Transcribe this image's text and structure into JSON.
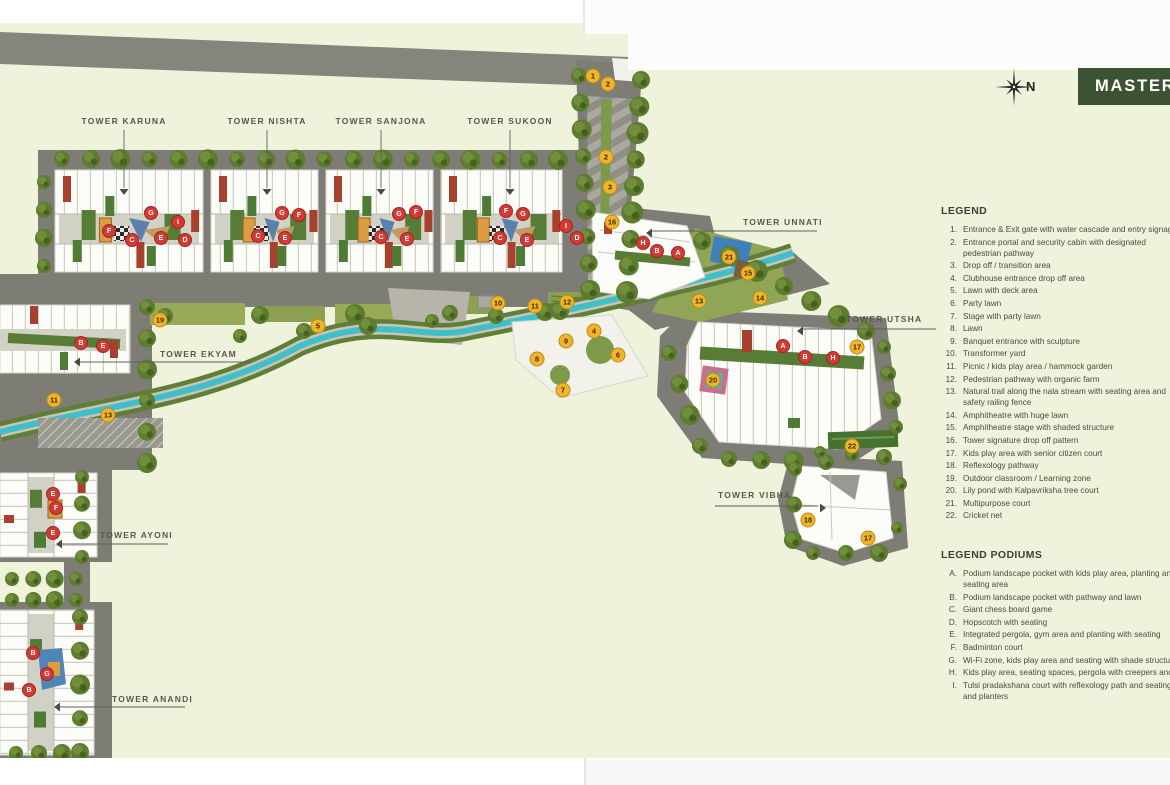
{
  "page": {
    "banner_label": "MASTER PLAN",
    "compass_label": "N"
  },
  "legend": {
    "title": "LEGEND",
    "items": [
      {
        "n": "1.",
        "t": "Entrance & Exit gate with water cascade and entry signage"
      },
      {
        "n": "2.",
        "t": "Entrance portal and security cabin with designated\npedestrian pathway"
      },
      {
        "n": "3.",
        "t": "Drop off / transition area"
      },
      {
        "n": "4.",
        "t": "Clubhouse entrance drop off area"
      },
      {
        "n": "5.",
        "t": "Lawn with deck area"
      },
      {
        "n": "6.",
        "t": "Party lawn"
      },
      {
        "n": "7.",
        "t": "Stage with party lawn"
      },
      {
        "n": "8.",
        "t": "Lawn"
      },
      {
        "n": "9.",
        "t": "Banquet entrance with sculpture"
      },
      {
        "n": "10.",
        "t": "Transformer yard"
      },
      {
        "n": "11.",
        "t": "Picnic / kids play area / hammock garden"
      },
      {
        "n": "12.",
        "t": "Pedestrian pathway with organic farm"
      },
      {
        "n": "13.",
        "t": "Natural trail along the nala stream with seating area and\nsafety railing fence"
      },
      {
        "n": "14.",
        "t": "Amphitheatre with huge lawn"
      },
      {
        "n": "15.",
        "t": "Amphitheatre stage with shaded structure"
      },
      {
        "n": "16.",
        "t": "Tower signature drop off pattern"
      },
      {
        "n": "17.",
        "t": "Kids play area with senior citizen court"
      },
      {
        "n": "18.",
        "t": "Reflexology pathway"
      },
      {
        "n": "19.",
        "t": "Outdoor classroom / Learning zone"
      },
      {
        "n": "20.",
        "t": "Lily pond with Kalpavriksha tree court"
      },
      {
        "n": "21.",
        "t": "Multipurpose court"
      },
      {
        "n": "22.",
        "t": "Cricket net"
      }
    ]
  },
  "legend_podiums": {
    "title": "LEGEND PODIUMS",
    "items": [
      {
        "n": "A.",
        "t": "Podium landscape pocket with kids play area, planting and\nseating area"
      },
      {
        "n": "B.",
        "t": "Podium landscape pocket with pathway and lawn"
      },
      {
        "n": "C.",
        "t": "Giant chess board game"
      },
      {
        "n": "D.",
        "t": "Hopscotch with seating"
      },
      {
        "n": "E.",
        "t": "Integrated pergola, gym area and planting with seating"
      },
      {
        "n": "F.",
        "t": "Badminton court"
      },
      {
        "n": "G.",
        "t": "Wi-Fi zone, kids play area and seating with shade structure"
      },
      {
        "n": "H.",
        "t": "Kids play area, seating spaces, pergola with creepers and"
      },
      {
        "n": "I.",
        "t": "Tulsi pradakshana court with reflexology path and seating\nand planters"
      }
    ]
  },
  "plan": {
    "towers": [
      {
        "id": "karuna",
        "name": "TOWER KARUNA"
      },
      {
        "id": "nishta",
        "name": "TOWER NISHTA"
      },
      {
        "id": "sanjona",
        "name": "TOWER SANJONA"
      },
      {
        "id": "sukoon",
        "name": "TOWER SUKOON"
      },
      {
        "id": "unnati",
        "name": "TOWER UNNATI"
      },
      {
        "id": "utsha",
        "name": "TOWER UTSHA"
      },
      {
        "id": "ekyam",
        "name": "TOWER EKYAM"
      },
      {
        "id": "ayoni",
        "name": "TOWER AYONI"
      },
      {
        "id": "vibha",
        "name": "TOWER VIBHA"
      },
      {
        "id": "anandi",
        "name": "TOWER ANANDI"
      }
    ],
    "markers": [
      {
        "t": "n",
        "label": "1",
        "x": 593,
        "y": 76
      },
      {
        "t": "n",
        "label": "2",
        "x": 608,
        "y": 84
      },
      {
        "t": "n",
        "label": "2",
        "x": 606,
        "y": 157
      },
      {
        "t": "n",
        "label": "3",
        "x": 610,
        "y": 187
      },
      {
        "t": "n",
        "label": "16",
        "x": 612,
        "y": 222
      },
      {
        "t": "n",
        "label": "21",
        "x": 729,
        "y": 257
      },
      {
        "t": "n",
        "label": "15",
        "x": 748,
        "y": 273
      },
      {
        "t": "n",
        "label": "14",
        "x": 760,
        "y": 298
      },
      {
        "t": "n",
        "label": "13",
        "x": 699,
        "y": 301
      },
      {
        "t": "n",
        "label": "12",
        "x": 567,
        "y": 302
      },
      {
        "t": "n",
        "label": "11",
        "x": 535,
        "y": 306
      },
      {
        "t": "n",
        "label": "10",
        "x": 498,
        "y": 303
      },
      {
        "t": "n",
        "label": "4",
        "x": 594,
        "y": 331
      },
      {
        "t": "n",
        "label": "9",
        "x": 566,
        "y": 341
      },
      {
        "t": "n",
        "label": "8",
        "x": 537,
        "y": 359
      },
      {
        "t": "n",
        "label": "6",
        "x": 618,
        "y": 355
      },
      {
        "t": "n",
        "label": "7",
        "x": 563,
        "y": 390
      },
      {
        "t": "n",
        "label": "5",
        "x": 318,
        "y": 326
      },
      {
        "t": "n",
        "label": "19",
        "x": 160,
        "y": 320
      },
      {
        "t": "n",
        "label": "11",
        "x": 54,
        "y": 400
      },
      {
        "t": "n",
        "label": "13",
        "x": 108,
        "y": 415
      },
      {
        "t": "n",
        "label": "17",
        "x": 857,
        "y": 347
      },
      {
        "t": "n",
        "label": "20",
        "x": 713,
        "y": 380
      },
      {
        "t": "n",
        "label": "22",
        "x": 852,
        "y": 446
      },
      {
        "t": "n",
        "label": "18",
        "x": 808,
        "y": 520
      },
      {
        "t": "n",
        "label": "17",
        "x": 868,
        "y": 538
      },
      {
        "t": "l",
        "label": "G",
        "x": 151,
        "y": 213
      },
      {
        "t": "l",
        "label": "F",
        "x": 109,
        "y": 231
      },
      {
        "t": "l",
        "label": "C",
        "x": 132,
        "y": 240
      },
      {
        "t": "l",
        "label": "E",
        "x": 161,
        "y": 238
      },
      {
        "t": "l",
        "label": "I",
        "x": 178,
        "y": 222
      },
      {
        "t": "l",
        "label": "D",
        "x": 185,
        "y": 240
      },
      {
        "t": "l",
        "label": "G",
        "x": 282,
        "y": 213
      },
      {
        "t": "l",
        "label": "F",
        "x": 299,
        "y": 215
      },
      {
        "t": "l",
        "label": "C",
        "x": 258,
        "y": 236
      },
      {
        "t": "l",
        "label": "E",
        "x": 285,
        "y": 238
      },
      {
        "t": "l",
        "label": "G",
        "x": 399,
        "y": 214
      },
      {
        "t": "l",
        "label": "F",
        "x": 416,
        "y": 212
      },
      {
        "t": "l",
        "label": "C",
        "x": 381,
        "y": 237
      },
      {
        "t": "l",
        "label": "E",
        "x": 407,
        "y": 239
      },
      {
        "t": "l",
        "label": "G",
        "x": 523,
        "y": 214
      },
      {
        "t": "l",
        "label": "F",
        "x": 506,
        "y": 211
      },
      {
        "t": "l",
        "label": "C",
        "x": 500,
        "y": 238
      },
      {
        "t": "l",
        "label": "E",
        "x": 527,
        "y": 240
      },
      {
        "t": "l",
        "label": "I",
        "x": 566,
        "y": 226
      },
      {
        "t": "l",
        "label": "D",
        "x": 577,
        "y": 238
      },
      {
        "t": "l",
        "label": "H",
        "x": 643,
        "y": 243
      },
      {
        "t": "l",
        "label": "B",
        "x": 657,
        "y": 251
      },
      {
        "t": "l",
        "label": "A",
        "x": 678,
        "y": 253
      },
      {
        "t": "l",
        "label": "A",
        "x": 783,
        "y": 346
      },
      {
        "t": "l",
        "label": "B",
        "x": 805,
        "y": 357
      },
      {
        "t": "l",
        "label": "H",
        "x": 833,
        "y": 358
      },
      {
        "t": "l",
        "label": "B",
        "x": 81,
        "y": 343
      },
      {
        "t": "l",
        "label": "E",
        "x": 103,
        "y": 346
      },
      {
        "t": "l",
        "label": "E",
        "x": 53,
        "y": 494
      },
      {
        "t": "l",
        "label": "F",
        "x": 56,
        "y": 508
      },
      {
        "t": "l",
        "label": "E",
        "x": 53,
        "y": 533
      },
      {
        "t": "l",
        "label": "B",
        "x": 33,
        "y": 653
      },
      {
        "t": "l",
        "label": "G",
        "x": 47,
        "y": 674
      },
      {
        "t": "l",
        "label": "B",
        "x": 29,
        "y": 690
      }
    ]
  },
  "colors": {
    "page_bg": "#eff3dc",
    "banner_bg": "#3d5233",
    "road": "#7e7d75",
    "stream": "#3fbfca",
    "marker_yellow": "#f2b42e",
    "marker_red": "#d23b34",
    "tree": "#5d7c2f"
  }
}
